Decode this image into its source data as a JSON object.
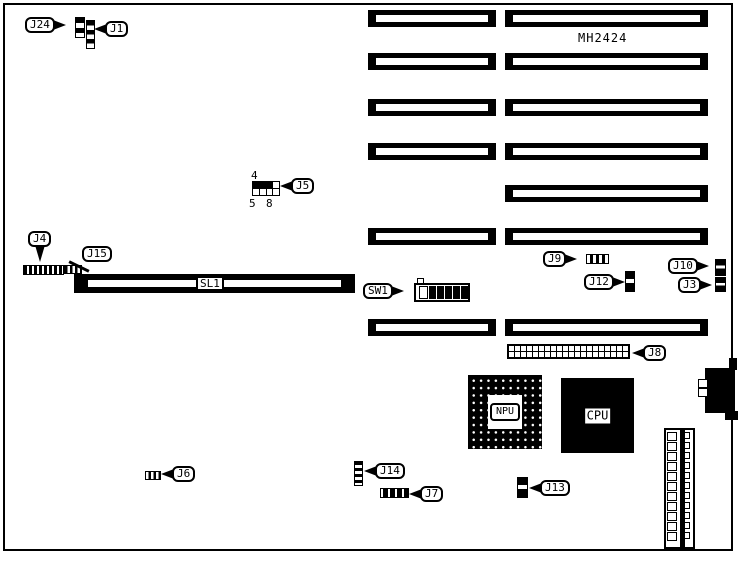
{
  "board": {
    "part_number": "MH2424",
    "slot_label": "SL1",
    "chips": {
      "npu": "NPU",
      "cpu": "CPU"
    },
    "callouts": {
      "j24": "J24",
      "j1": "J1",
      "j5": "J5",
      "j4": "J4",
      "j15": "J15",
      "sw1": "SW1",
      "j9": "J9",
      "j10": "J10",
      "j12": "J12",
      "j3": "J3",
      "j8": "J8",
      "j6": "J6",
      "j14": "J14",
      "j7": "J7",
      "j13": "J13"
    },
    "j5_pin_numbers": {
      "top_left": "4",
      "bottom_left": "5",
      "bottom_right": "8"
    }
  }
}
